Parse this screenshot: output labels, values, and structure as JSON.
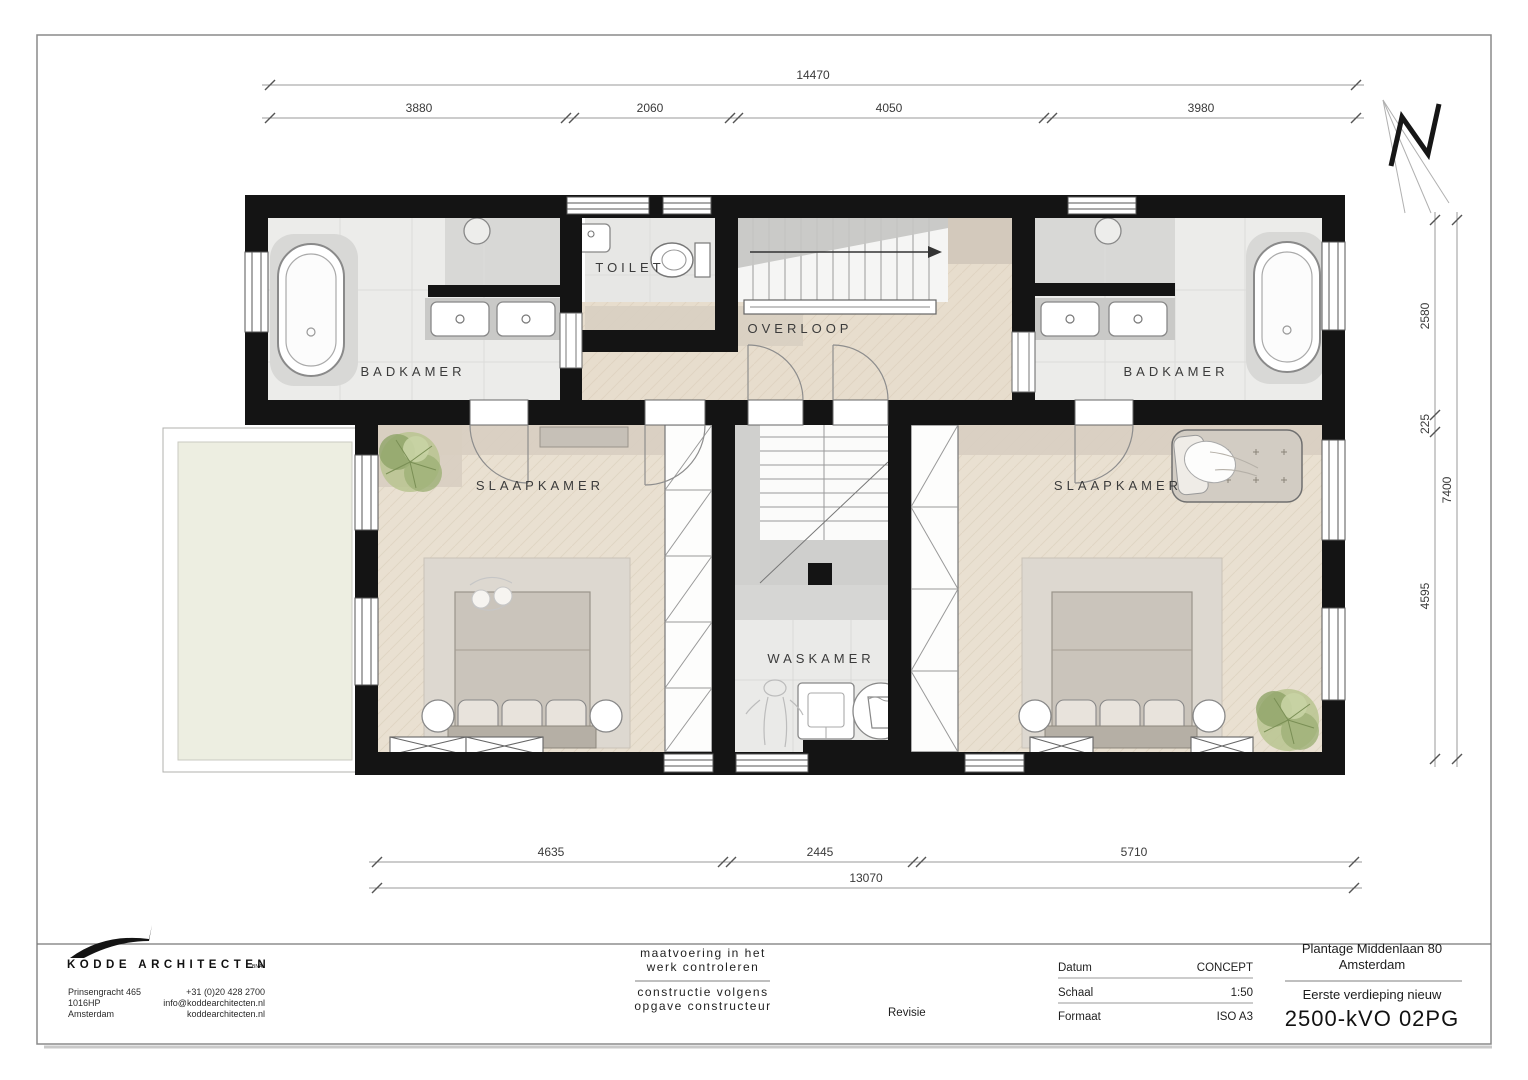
{
  "north": {
    "letter": "N"
  },
  "dimensions": {
    "top": {
      "total": "14470",
      "segments": [
        "3880",
        "2060",
        "4050",
        "3980"
      ]
    },
    "bottom": {
      "total": "13070",
      "segments": [
        "4635",
        "2445",
        "5710"
      ]
    },
    "right": {
      "total": "7400",
      "segments": [
        "2580",
        "225",
        "4595"
      ]
    }
  },
  "rooms": {
    "badkamer_left": "BADKAMER",
    "toilet": "TOILET",
    "overloop": "OVERLOOP",
    "badkamer_right": "BADKAMER",
    "slaapkamer_left": "SLAAPKAMER",
    "slaapkamer_right": "SLAAPKAMER",
    "waskamer": "WASKAMER"
  },
  "title_block": {
    "firm": {
      "name": "KODDE ARCHITECTEN",
      "suffix": "BNA",
      "address": [
        "Prinsengracht 465",
        "1016HP",
        "Amsterdam"
      ],
      "contact": [
        "+31 (0)20 428 2700",
        "info@koddearchitecten.nl",
        "koddearchitecten.nl"
      ]
    },
    "notes": {
      "line1": "maatvoering in het",
      "line2": "werk controleren",
      "line3": "constructie volgens",
      "line4": "opgave constructeur"
    },
    "revisie_label": "Revisie",
    "meta": [
      {
        "label": "Datum",
        "value": "CONCEPT"
      },
      {
        "label": "Schaal",
        "value": "1:50"
      },
      {
        "label": "Formaat",
        "value": "ISO A3"
      }
    ],
    "project": {
      "address1": "Plantage Middenlaan 80",
      "address2": "Amsterdam",
      "subtitle": "Eerste verdieping nieuw",
      "code": "2500-kVO 02PG"
    }
  }
}
